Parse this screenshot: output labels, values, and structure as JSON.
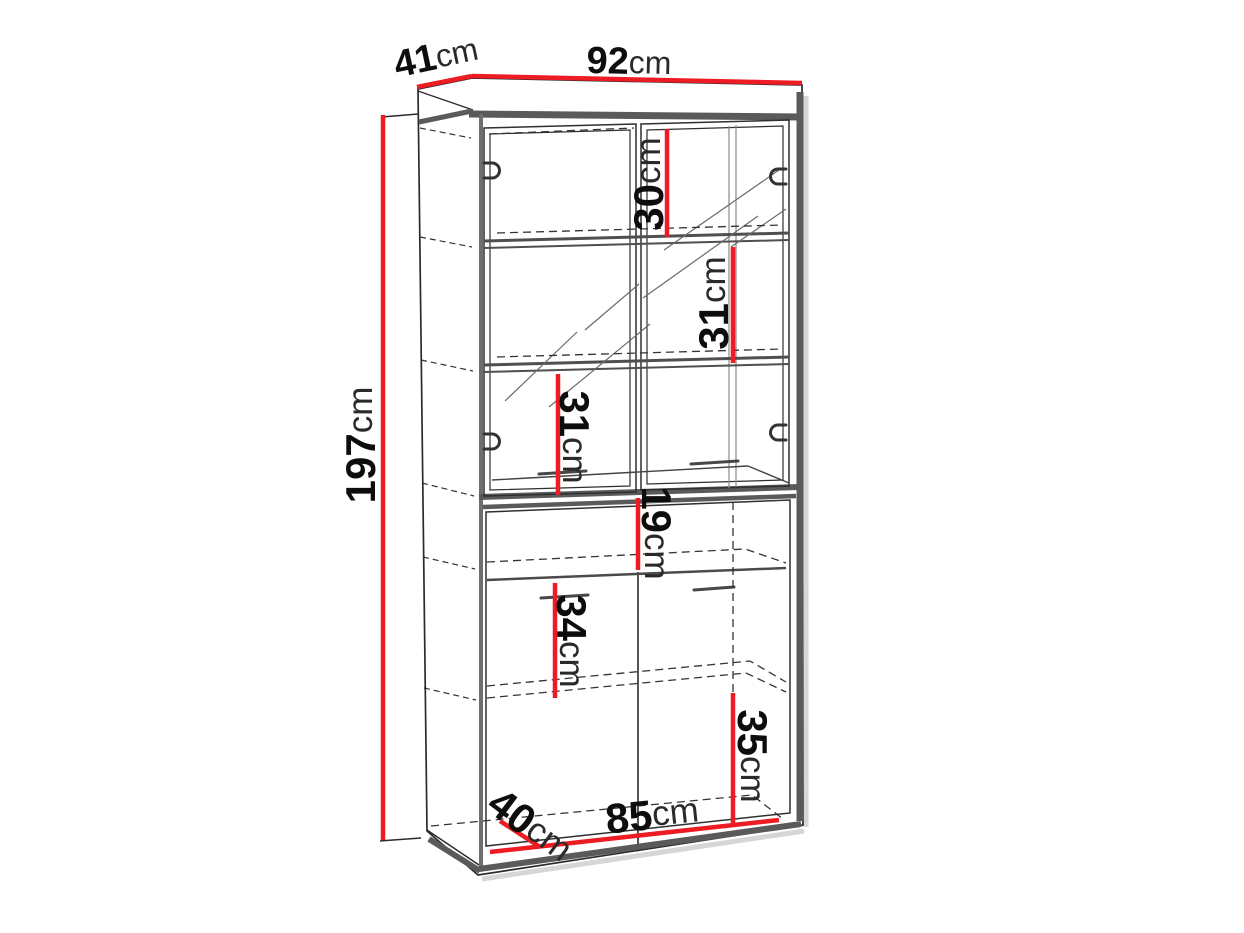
{
  "diagram": {
    "type": "furniture-dimension-diagram",
    "subject": "tall display cabinet with sliding glass doors (top) and two doors (bottom)",
    "background_color": "#ffffff",
    "dimension_line_color": "#ED1C24",
    "frame_color": "#5a5a5a",
    "outline_color": "#2b2b2b"
  },
  "dimensions": {
    "depth": {
      "value": "41",
      "unit": "cm"
    },
    "width": {
      "value": "92",
      "unit": "cm"
    },
    "height": {
      "value": "197",
      "unit": "cm"
    },
    "top_compartment": {
      "value": "30",
      "unit": "cm"
    },
    "upper_compartment_right": {
      "value": "31",
      "unit": "cm"
    },
    "upper_compartment_left": {
      "value": "31",
      "unit": "cm"
    },
    "open_niche": {
      "value": "19",
      "unit": "cm"
    },
    "lower_compartment_left": {
      "value": "34",
      "unit": "cm"
    },
    "lower_compartment_right": {
      "value": "35",
      "unit": "cm"
    },
    "inner_depth": {
      "value": "40",
      "unit": "cm"
    },
    "inner_width": {
      "value": "85",
      "unit": "cm"
    }
  }
}
